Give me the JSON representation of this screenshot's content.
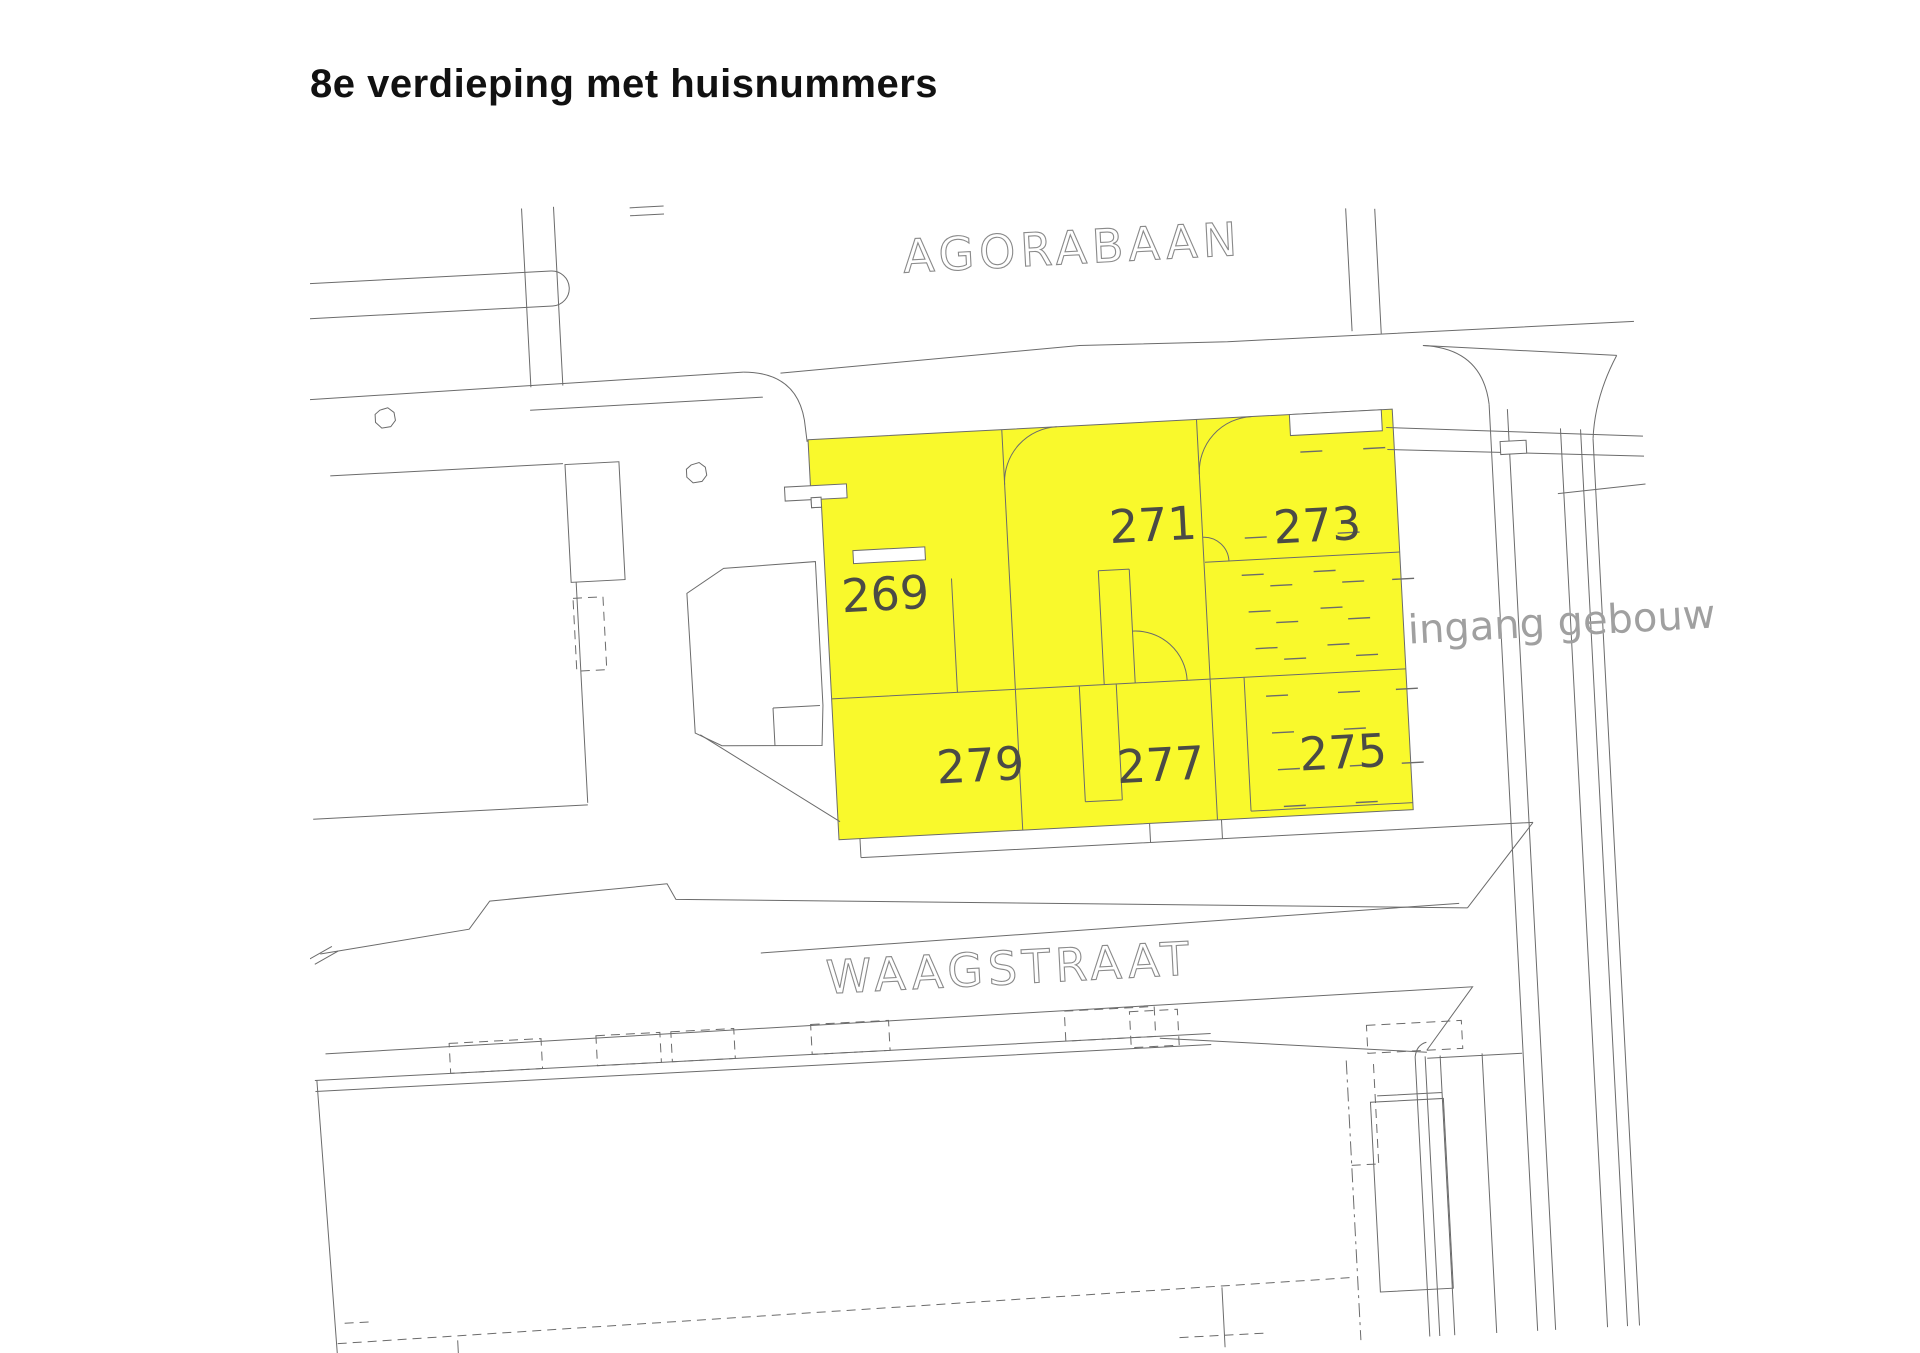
{
  "title": "8e verdieping met huisnummers",
  "streets": {
    "top": "AGORABAAN",
    "bottom": "WAAGSTRAAT"
  },
  "annotation": "ingang gebouw",
  "rooms": [
    {
      "number": "269"
    },
    {
      "number": "271"
    },
    {
      "number": "273"
    },
    {
      "number": "275"
    },
    {
      "number": "277"
    },
    {
      "number": "279"
    }
  ],
  "colors": {
    "background": "#ffffff",
    "highlight": "#f9f92c",
    "line": "#6b6b6b",
    "room_number": "#4b4b46",
    "street_label": "#8a8a8a",
    "annotation": "#a0a0a0",
    "title": "#111111"
  }
}
